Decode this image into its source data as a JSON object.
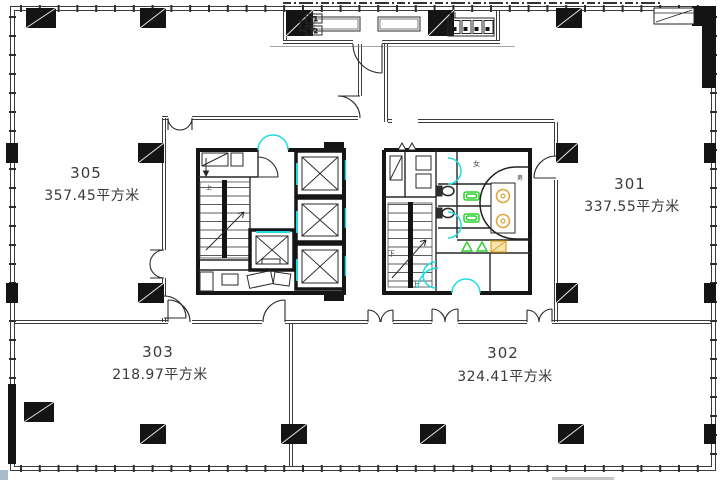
{
  "drawing": {
    "rooms": [
      {
        "number": "305",
        "area": "357.45平方米"
      },
      {
        "number": "301",
        "area": "337.55平方米"
      },
      {
        "number": "303",
        "area": "218.97平方米"
      },
      {
        "number": "302",
        "area": "324.41平方米"
      }
    ],
    "annotations": {
      "women_room": "女",
      "men_room": "男",
      "stair_up": "上",
      "stair_down": "下",
      "riser_1": "Y1",
      "riser_2": "Y2"
    },
    "colors": {
      "wall_line": "#3c3c3c",
      "solid_wall": "#141414",
      "door_highlight_cyan": "#1fdbe3",
      "fixture_green": "#2bd02b",
      "fixture_orange": "#dfa63a",
      "background": "#ffffff"
    }
  }
}
